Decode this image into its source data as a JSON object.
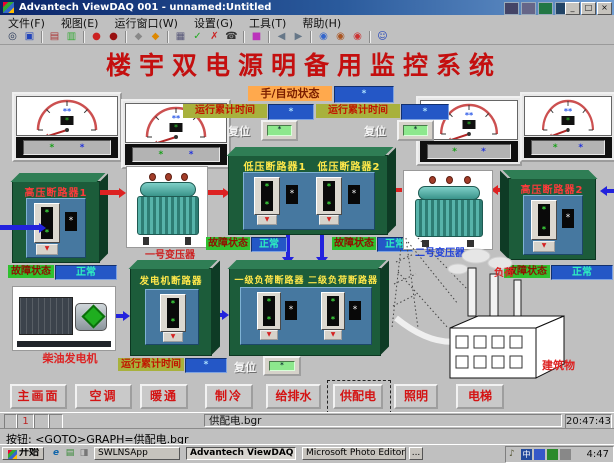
{
  "window": {
    "title": "Advantech ViewDAQ 001 - unnamed:Untitled",
    "menu_items": [
      "文件(F)",
      "视图(E)",
      "运行窗口(W)",
      "设置(G)",
      "工具(T)",
      "帮助(H)"
    ],
    "minimize_glyph": "_",
    "restore_glyph": "□",
    "close_glyph": "×"
  },
  "toolbar": {
    "icons": [
      {
        "name": "zoom-icon",
        "glyph": "◎"
      },
      {
        "name": "monitor-icon",
        "glyph": "▣"
      },
      {
        "name": "trend-chart-icon",
        "glyph": "▤"
      },
      {
        "name": "bar-chart-icon",
        "glyph": "▥"
      },
      {
        "name": "alarm-ball-red-icon",
        "glyph": "●"
      },
      {
        "name": "alarm-ball-dark-icon",
        "glyph": "●"
      },
      {
        "name": "tag-gray-icon",
        "glyph": "◆"
      },
      {
        "name": "tag-orange-icon",
        "glyph": "◆"
      },
      {
        "name": "report-icon",
        "glyph": "▦"
      },
      {
        "name": "confirm-icon",
        "glyph": "✓"
      },
      {
        "name": "cancel-icon",
        "glyph": "✗"
      },
      {
        "name": "dial-icon",
        "glyph": "☎"
      },
      {
        "name": "palette-icon",
        "glyph": "■"
      },
      {
        "name": "back-icon",
        "glyph": "◀"
      },
      {
        "name": "forward-icon",
        "glyph": "▶"
      },
      {
        "name": "globe-blue-icon",
        "glyph": "◉"
      },
      {
        "name": "globe-brown-icon",
        "glyph": "◉"
      },
      {
        "name": "globe-red-icon",
        "glyph": "◉"
      },
      {
        "name": "operator-icon",
        "glyph": "☺"
      }
    ]
  },
  "scada": {
    "banner": "楼宇双电源明备用监控系统",
    "glyphs": {
      "star": "*",
      "white_star": "*",
      "indicator": "▼",
      "reset_dot": "*"
    },
    "mode": {
      "label": "手/自动状态",
      "value": "*"
    },
    "runtime_top": [
      {
        "label": "运行累计时间",
        "value": "*"
      },
      {
        "label": "运行累计时间",
        "value": "*"
      }
    ],
    "reset_top": [
      {
        "label": "复位"
      },
      {
        "label": "复位"
      }
    ],
    "meters": [
      {
        "face": "*",
        "left": "*",
        "right": "*"
      },
      {
        "face": "*",
        "left": "*",
        "right": "*"
      },
      {
        "face": "*",
        "left": "*",
        "right": "*"
      },
      {
        "face": "*",
        "left": "*",
        "right": "*"
      }
    ],
    "hv1": {
      "title": "高压断路器1",
      "status_label": "故障状态",
      "status_value": "正常"
    },
    "hv2": {
      "title": "高压断路器2",
      "status_label": "故障状态",
      "status_value": "正常"
    },
    "lv": {
      "title1": "低压断路器1",
      "title2": "低压断路器2",
      "status_left_label": "故障状态",
      "status_left_value": "正常",
      "status_right_label": "故障状态",
      "status_right_value": "正常"
    },
    "gen_box": {
      "title": "发电机断路器"
    },
    "load_box": {
      "title1": "一级负荷断路器",
      "title2": "二级负荷断路器"
    },
    "gen_runtime": {
      "label": "运行累计时间",
      "value": "*",
      "reset_label": "复位"
    },
    "transformer1_label": "一号变压器",
    "transformer2_label": "二号变压器",
    "generator_label": "柴油发电机",
    "load_tag": "负荷",
    "building_label": "建筑物"
  },
  "nav": {
    "buttons": [
      {
        "label": "主画面"
      },
      {
        "label": "空调"
      },
      {
        "label": "暖通"
      },
      {
        "label": "制冷"
      },
      {
        "label": "给排水"
      },
      {
        "label": "供配电"
      },
      {
        "label": "照明"
      },
      {
        "label": "电梯"
      }
    ]
  },
  "status": {
    "page": "1",
    "file": "供配电.bgr",
    "clock": "20:47:43",
    "prompt": "按钮: <GOTO>GRAPH=供配电.bgr"
  },
  "taskbar": {
    "start_label": "开始",
    "quick_launch": [
      {
        "name": "ie-icon",
        "glyph": "e"
      },
      {
        "name": "desktop-icon",
        "glyph": "▤"
      },
      {
        "name": "channels-icon",
        "glyph": "◨"
      }
    ],
    "tasks": [
      {
        "label": "SWLNSApp"
      },
      {
        "label": "Advantech ViewDAQ 00..."
      },
      {
        "label": "Microsoft Photo Editor"
      }
    ],
    "overflow": "...",
    "tray": {
      "speaker_glyph": "♪",
      "ime_glyph": "中",
      "time": "4:47"
    }
  }
}
